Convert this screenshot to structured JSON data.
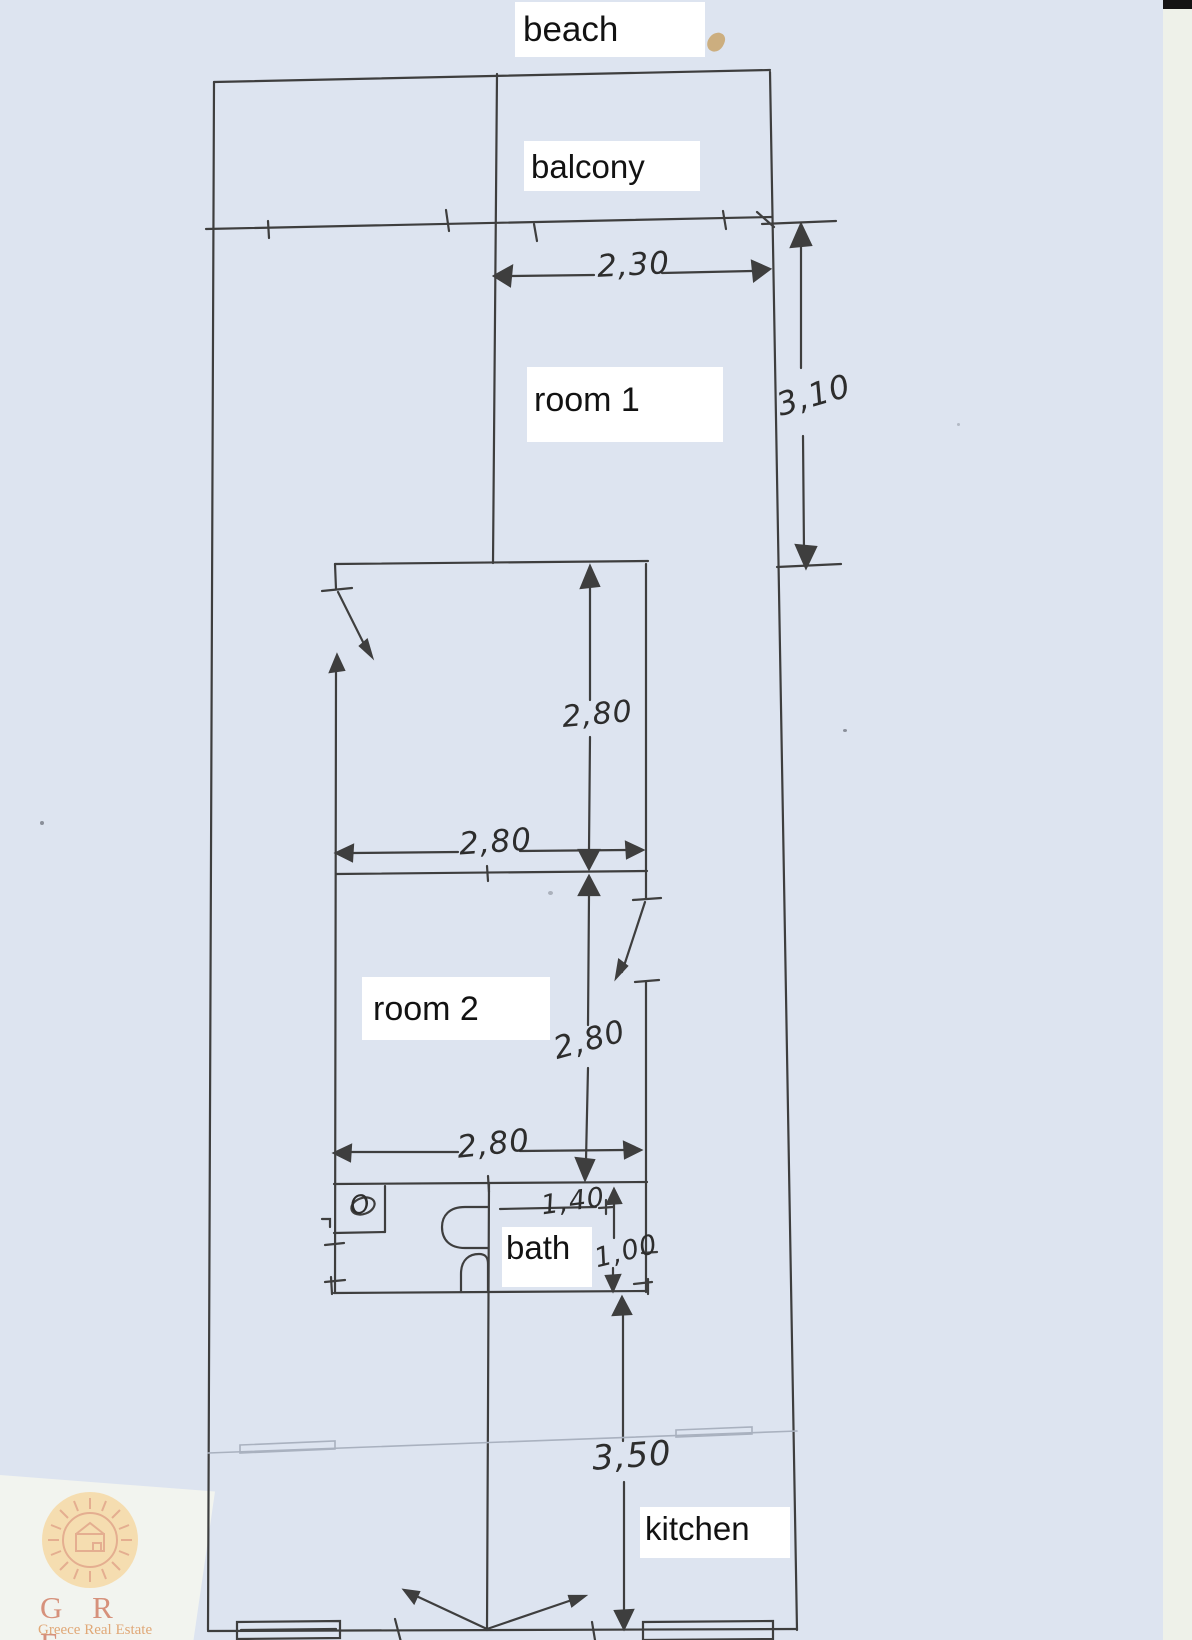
{
  "plan": {
    "areas": {
      "beach": "beach",
      "balcony": "balcony",
      "room1": "room 1",
      "room2": "room 2",
      "bath": "bath",
      "kitchen": "kitchen"
    },
    "dimensions": {
      "balcony_width": "2,30",
      "room1_depth": "3,10",
      "room2_upper_depth": "2,80",
      "room2_upper_width": "2,80",
      "room2_lower_depth": "2,80",
      "room2_lower_width": "2,80",
      "bath_width": "1,40",
      "bath_depth": "1,00",
      "kitchen_depth": "3,50"
    },
    "fixtures": {
      "toilet_mark": "O"
    }
  },
  "logo": {
    "initials": "G R E",
    "name": "Greece Real Estate"
  },
  "colors": {
    "paper": "#dde4f0",
    "ink": "#3e3e3e",
    "faint_ink": "#a9b1bf",
    "label_bg": "#ffffff",
    "logo_text": "#d0795f",
    "logo_sun": "#dd8a5e",
    "logo_disc": "#f8d28f",
    "scan_strip": "#eef1e9",
    "scan_bar": "#141414"
  }
}
